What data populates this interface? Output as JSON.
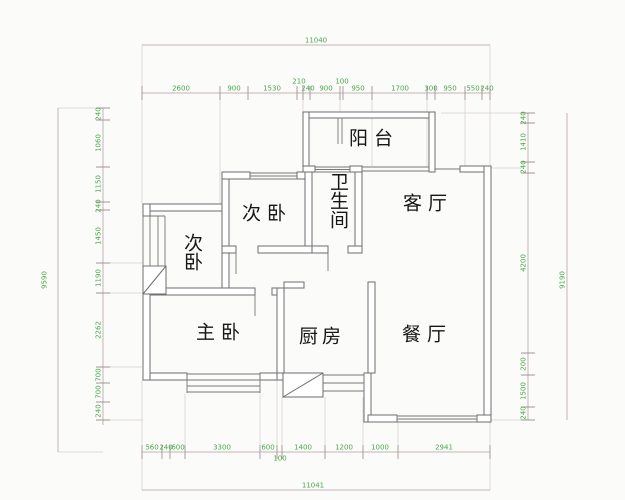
{
  "rooms": {
    "balcony": "阳台",
    "bathroom": "卫生间",
    "bedroom2_center": "次卧",
    "bedroom2_left": "次卧",
    "living": "客厅",
    "master": "主卧",
    "kitchen": "厨房",
    "dining": "餐厅"
  },
  "dims": {
    "top_total": "11040",
    "top": [
      "2600",
      "900",
      "1530",
      "210",
      "240",
      "900",
      "100",
      "950",
      "1700",
      "300",
      "950",
      "550",
      "240"
    ],
    "left_total": "9590",
    "left": [
      "240",
      "1060",
      "1150",
      "240",
      "1450",
      "1190",
      "2262",
      "700",
      "700",
      "240"
    ],
    "right": [
      "240",
      "1410",
      "240",
      "4200",
      "200",
      "1500",
      "240"
    ],
    "right_total": "9190",
    "bottom": [
      "560",
      "240",
      "600",
      "3300",
      "600",
      "100",
      "1400",
      "1200",
      "1000",
      "2941"
    ],
    "bottom_total": "11041"
  },
  "colors": {
    "dimension_text": "#4aa84a",
    "wall_line": "#6e6e6e",
    "dimension_line": "#c4b6b6"
  }
}
